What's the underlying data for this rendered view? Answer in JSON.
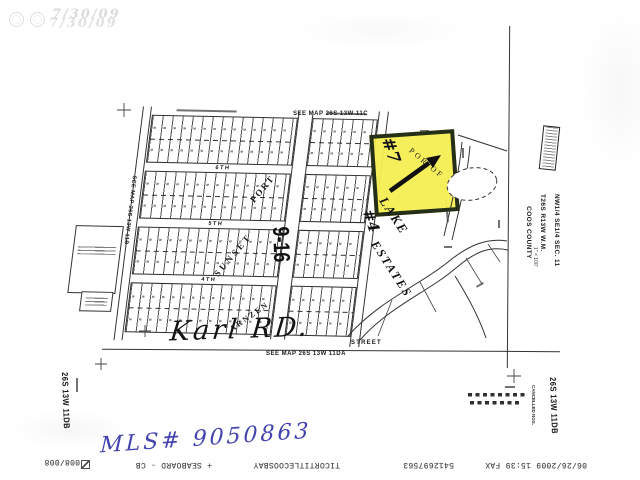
{
  "stamps": {
    "ghost_date": "7/30/09"
  },
  "plat": {
    "see_map_top": "SEE MAP 26S 13W 11C",
    "see_map_left": "SEE MAP 26S 13W 11B",
    "see_map_bottom": "SEE MAP 26S 13W 11DA",
    "streets": {
      "s6": "6TH",
      "s5": "5TH",
      "s4": "4TH",
      "bottom_label": "STREET"
    },
    "road_number": "9-16",
    "overlays": {
      "d1": "PORT",
      "d2": "SUNSET",
      "d3": "ARNZEN"
    },
    "estates": {
      "name_line1": "LAKE",
      "name_line2": "ESTATES",
      "por_of": "POR OF",
      "lot7": "#7",
      "lot4": "#4"
    }
  },
  "margins": {
    "legal": "NW1/4 SE1/4 SEC. 11 T26S R13W W.M.",
    "county": "COOS COUNTY",
    "scale": "1\" = 100'",
    "sheet_id_right": "26S 13W 11DB",
    "sheet_id_left": "26S 13W 11DB",
    "cancelled_label": "CANCELLED NOS."
  },
  "handwriting": {
    "road_name": "Karl RD.",
    "mls_number": "MLS# 9050863",
    "ink_color": "#4343b0"
  },
  "highlight_color": "#f4ee52",
  "icons": {
    "fax_pages": "boxed-z-icon",
    "section_corner": "cross-marker-icon",
    "arrow": "hand-drawn-arrow-icon"
  },
  "fax_footer": {
    "datetime": "06/26/2009 15:39 FAX",
    "fax_number": "5412697563",
    "sender": "TICORTITLECOOSBAY",
    "recipient": "+ SEABOARD - CB",
    "pages": "008/008"
  }
}
